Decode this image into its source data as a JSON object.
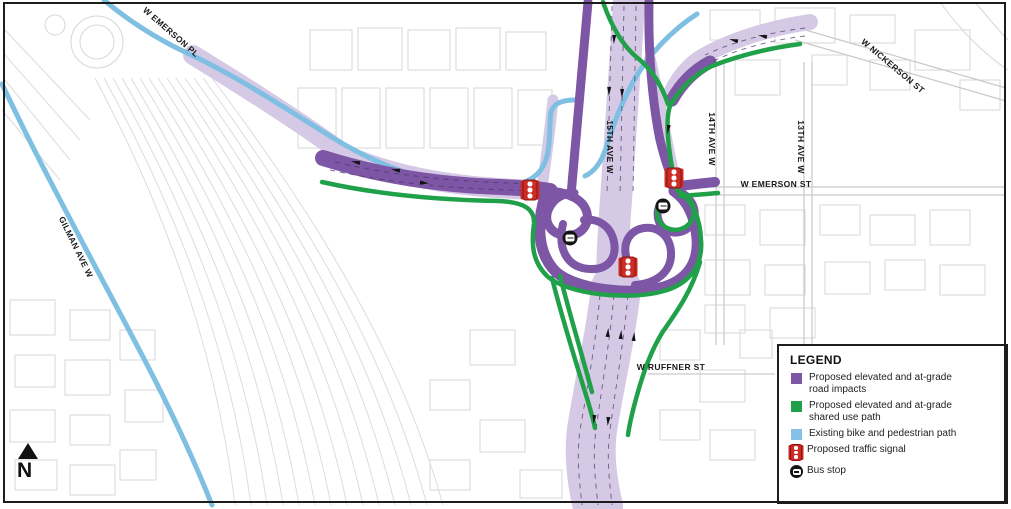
{
  "streets": {
    "w_emerson_pl": "W EMERSON PL",
    "w_nickerson_st": "W NICKERSON ST",
    "gilman_ave_w": "GILMAN AVE W",
    "fifteenth_ave_w": "15TH AVE W",
    "fourteenth_ave_w": "14TH AVE W",
    "thirteenth_ave_w": "13TH AVE W",
    "w_emerson_st": "W EMERSON ST",
    "w_ruffner_st": "W RUFFNER ST"
  },
  "compass": {
    "north_label": "N"
  },
  "legend": {
    "title": "LEGEND",
    "items": [
      {
        "id": "road-impacts",
        "swatch": "square",
        "color": "#7D56A5",
        "lines": [
          "Proposed elevated and at-grade",
          "road impacts"
        ]
      },
      {
        "id": "shared-use-path",
        "swatch": "square",
        "color": "#21A04A",
        "lines": [
          "Proposed elevated and at-grade",
          "shared use path"
        ]
      },
      {
        "id": "bike-ped-path",
        "swatch": "square",
        "color": "#85C1E4",
        "lines": [
          "Existing bike and pedestrian path"
        ]
      },
      {
        "id": "traffic-signal",
        "swatch": "signal-icon",
        "color": "#CD2B26",
        "lines": [
          "Proposed traffic signal"
        ]
      },
      {
        "id": "bus-stop",
        "swatch": "bus-icon",
        "color": "#141414",
        "lines": [
          "Bus stop"
        ]
      }
    ]
  },
  "markers": {
    "traffic_signal_count": 3,
    "bus_stop_count": 2
  },
  "colors": {
    "road_impacts_purple": "#7D56A5",
    "road_light_purple": "#D5C9E5",
    "shared_use_green": "#21A04A",
    "bike_path_blue": "#7FBFE2",
    "signal_red": "#CD2B26",
    "bus_black": "#141414",
    "map_line_gray": "#D4D4D4",
    "border_black": "#1D1D1D"
  }
}
